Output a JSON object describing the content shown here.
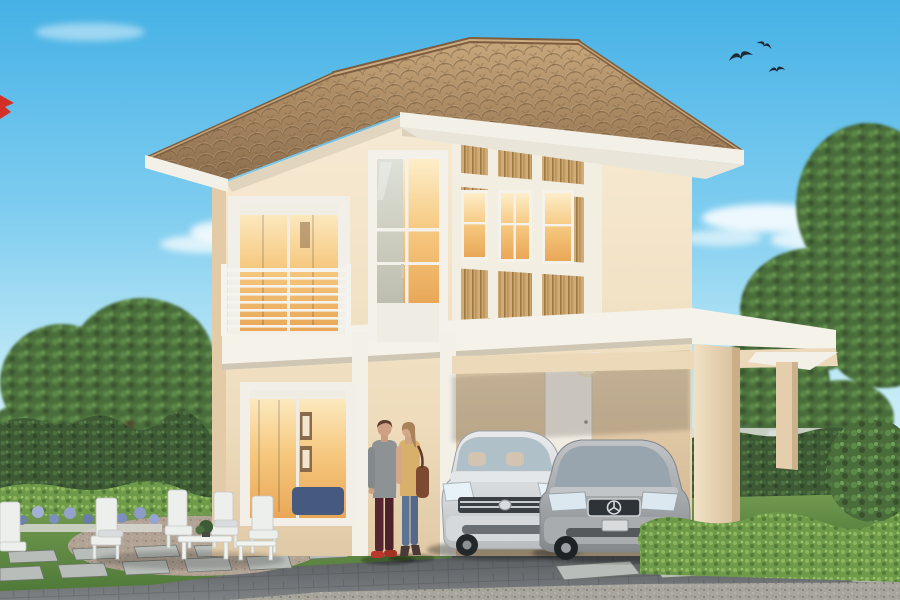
{
  "scene": {
    "kind": "exterior-architectural-render",
    "subject": "Two-story cream house with brown tiled hip roof, wood-slat accent facade, balcony, carport with two cars, couple walking, white garden furniture, hedges and trees",
    "counts": {
      "birds": 3,
      "cars": 2,
      "people": 2,
      "patio_chairs": 4,
      "patio_tables": 2
    },
    "objects": {
      "cars": [
        "white-minivan",
        "silver-sedan"
      ],
      "people": [
        "man-gray-sweater-dark-red-pants",
        "woman-tan-top-jeans-shoulder-bag"
      ],
      "landscape": [
        "left-tree-mass",
        "right-tree-mass",
        "boundary-hedge-wall",
        "low-bright-hedge",
        "lavender-flower-planter",
        "lawn",
        "paved-driveway",
        "stepping-stones",
        "gravel-strip"
      ]
    }
  },
  "palette": {
    "sky_top": "#4fb6e6",
    "sky_low": "#cdeef8",
    "roof_tile_light": "#c5a379",
    "roof_tile_dark": "#8a6b4a",
    "wall_cream": "#f5e7cf",
    "wall_shadow": "#d9c2a2",
    "wall_dim": "#e6d0b0",
    "trim_white": "#f4f1ea",
    "side_wall_gray": "#b7c3cb",
    "slat_wood": "#c9a56f",
    "window_glow": "#f6c87f",
    "hedge_dark": "#3e5c37",
    "hedge_bright": "#6e9b49",
    "lawn": "#5f8a43",
    "tree_green": "#4a6d3b",
    "driveway": "#63676a",
    "gravel": "#a7a59c",
    "stone": "#b9bdb9",
    "car_white": "#dde0e2",
    "car_silver": "#a7abae",
    "bird": "#1d2a33",
    "flag_red": "#d42f27"
  }
}
